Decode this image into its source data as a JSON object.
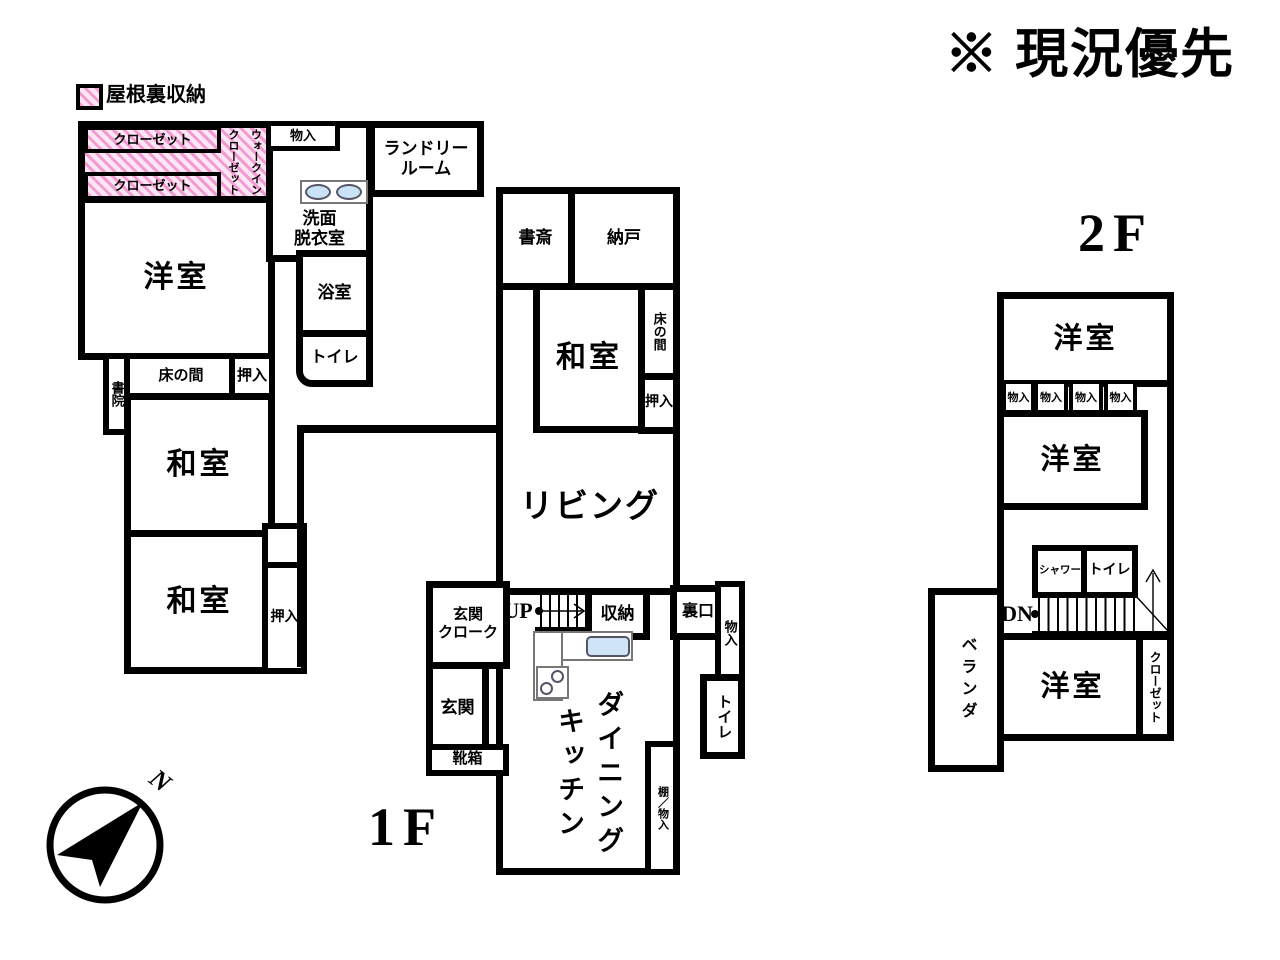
{
  "annotation": "※ 現況優先",
  "legend": {
    "attic_storage": "屋根裏収納"
  },
  "compass": {
    "north": "N"
  },
  "floor1": {
    "title": "1F",
    "rooms": {
      "closet_a": "クローゼット",
      "closet_b": "クローゼット",
      "walk_in_closet": "ウォークインクローゼット",
      "storage_top": "物入",
      "laundry_room": "ランドリー\nルーム",
      "washroom": "洗面\n脱衣室",
      "bathroom": "浴室",
      "toilet_a": "トイレ",
      "western_room": "洋室",
      "shoin": "書院",
      "tokonoma_a": "床の間",
      "oshiire_a": "押入",
      "japanese_room_a": "和室",
      "japanese_room_b": "和室",
      "oshiire_b": "押入",
      "study": "書斎",
      "storeroom": "納戸",
      "japanese_room_c": "和室",
      "tokonoma_b": "床の間",
      "oshiire_c": "押入",
      "living": "リビング",
      "entrance_cloak": "玄関\nクローク",
      "stairs_up": "UP",
      "storage_stairs": "収納",
      "back_door": "裏口",
      "storage_tall": "物入",
      "toilet_b": "トイレ",
      "entrance": "玄関",
      "shoe_box": "靴箱",
      "dining_kitchen": "ダイニングキッチン",
      "shelf_storage": "棚／物入"
    }
  },
  "floor2": {
    "title": "2F",
    "rooms": {
      "western_room_a": "洋室",
      "storage_1": "物入",
      "storage_2": "物入",
      "storage_3": "物入",
      "storage_4": "物入",
      "western_room_b": "洋室",
      "shower": "シャワー",
      "toilet": "トイレ",
      "stairs_down": "DN",
      "veranda": "ベランダ",
      "western_room_c": "洋室",
      "closet": "クローゼット"
    }
  }
}
